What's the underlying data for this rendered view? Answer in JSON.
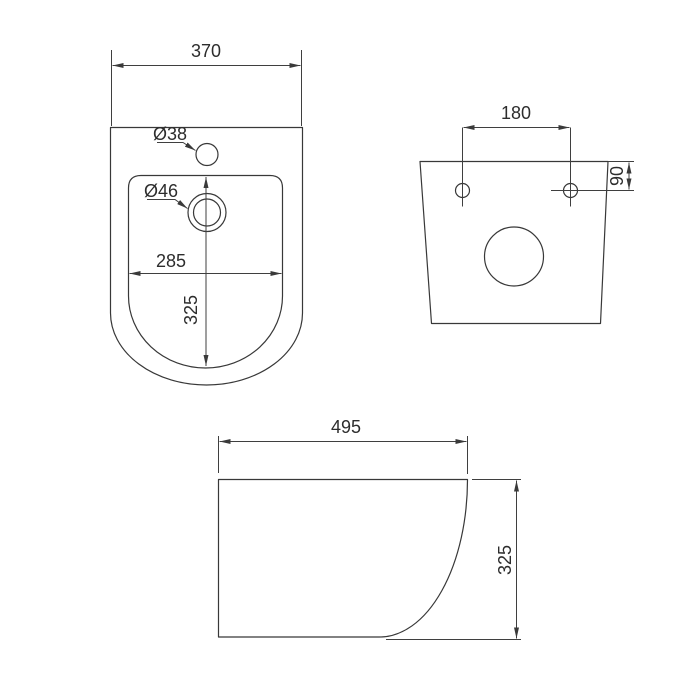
{
  "meta": {
    "background_color": "#ffffff",
    "line_color": "#3a3a3a",
    "text_color": "#2d2d2d"
  },
  "views": {
    "top": {
      "overall_width": "370",
      "faucet_hole_diameter": "Ø38",
      "drain_diameter": "Ø46",
      "inner_width": "285",
      "inner_depth": "325"
    },
    "back": {
      "mounting_hole_spacing": "180",
      "mounting_hole_offset": "90"
    },
    "side": {
      "length": "495",
      "height": "325"
    }
  }
}
